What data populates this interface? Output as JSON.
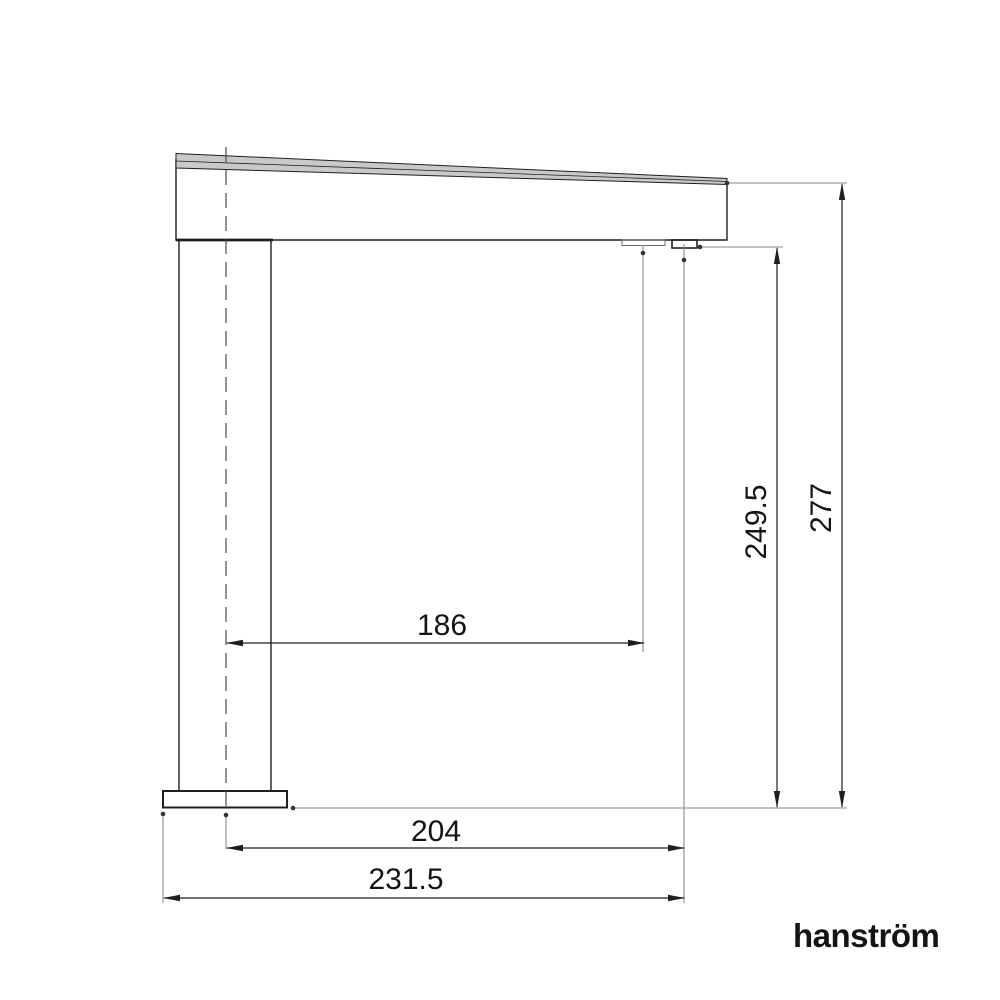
{
  "dims": {
    "spout_reach": "186",
    "spout_projection": "204",
    "overall_projection": "231.5",
    "outlet_height": "249.5",
    "overall_height": "277"
  },
  "brand": {
    "logo": "hanström"
  },
  "colors": {
    "background": "#ffffff",
    "outline": "#1f1f1f",
    "thin": "#8a8a8a",
    "centerline": "#4a4a4a",
    "surface": "#c9c9c9",
    "text": "#141414"
  }
}
